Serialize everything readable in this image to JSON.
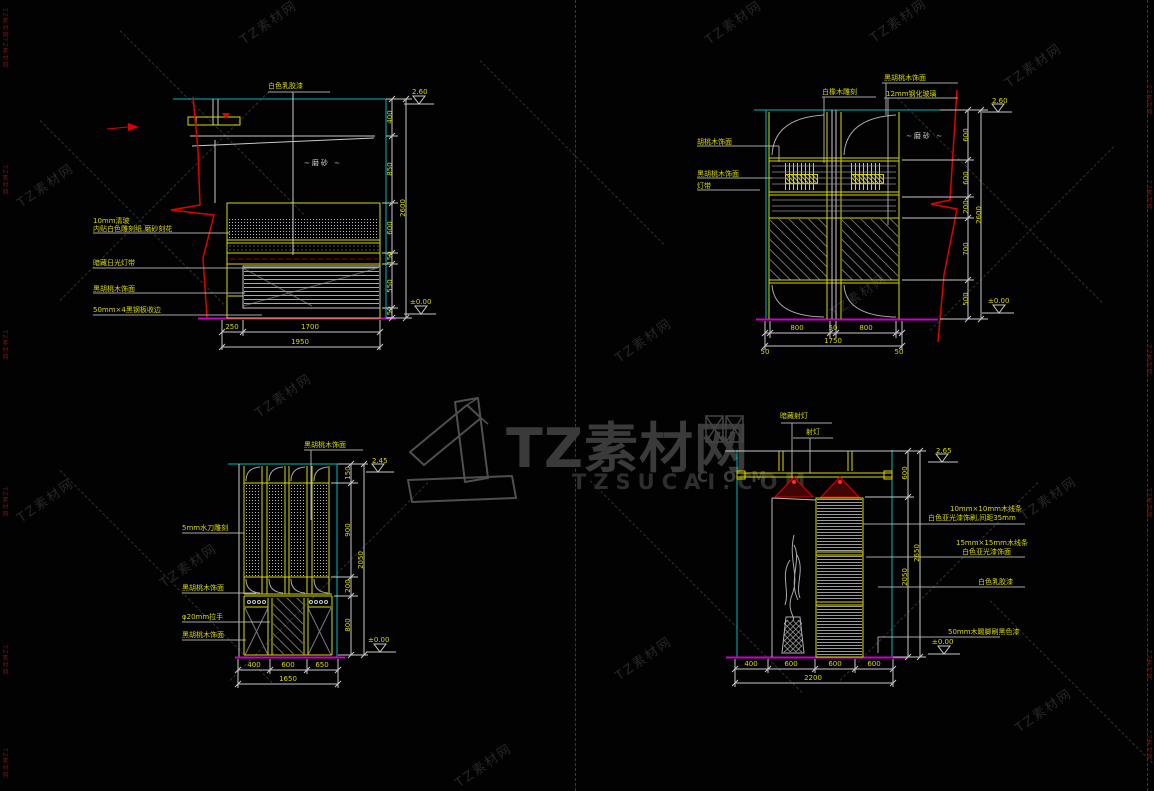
{
  "watermark": {
    "logo": "TZ素材网",
    "domain": "TZSUCAI.COM",
    "com": "C O M",
    "tile": "TZ素材网",
    "edge": "TZ素材网"
  },
  "d1": {
    "top_label": "白色乳胶漆",
    "frost_note": "∼磨砂 ∼",
    "left_labels": [
      "10mm清玻",
      "内贴白色雕刻纸,磨砂刻花",
      "暗藏日光灯带",
      "黑胡桃木饰面",
      "50mm×4黑钢板收边"
    ],
    "dims_right": [
      "400",
      "850",
      "600",
      "150",
      "550",
      "150"
    ],
    "overall_right": "2600",
    "level_top": "2.60",
    "level_bottom": "±0.00",
    "dims_bottom": [
      "250",
      "1700"
    ],
    "overall_bottom": "1950"
  },
  "d2": {
    "top_labels": [
      "黑胡桃木饰面",
      "白橡木雕刻",
      "12mm钢化玻璃"
    ],
    "left_labels": [
      "胡桃木饰面",
      "黑胡桃木饰面",
      "灯带"
    ],
    "frost_note": "∼磨砂 ∼",
    "dims_right": [
      "600",
      "600",
      "200",
      "700",
      "500"
    ],
    "overall_right": "2600",
    "level_top": "2.60",
    "level_bottom": "±0.00",
    "dims_bottom": [
      "800",
      "50",
      "800"
    ],
    "overall_bottom": "1750",
    "edge_dims": [
      "50",
      "50"
    ]
  },
  "d3": {
    "top_label": "黑胡桃木饰面",
    "left_labels": [
      "5mm水刀雕刻",
      "黑胡桃木饰面",
      "φ20mm拉手",
      "黑胡桃木饰面"
    ],
    "dims_right": [
      "150",
      "900",
      "200",
      "800"
    ],
    "overall_right": "2050",
    "level_top": "2.45",
    "level_bottom": "±0.00",
    "dims_bottom": [
      "400",
      "600",
      "650"
    ],
    "overall_bottom": "1650"
  },
  "d4": {
    "top_labels": [
      "暗藏射灯",
      "射灯"
    ],
    "right_labels": [
      [
        "10mm×10mm木线条",
        "白色亚光漆饰刷,间距35mm"
      ],
      [
        "15mm×15mm木线条",
        "白色亚光漆饰面"
      ],
      [
        "白色乳胶漆"
      ],
      [
        "50mm木踢脚刷黑色漆"
      ]
    ],
    "dims_right": [
      "600",
      "2050"
    ],
    "overall_right": "2650",
    "level_top": "2.65",
    "level_bottom": "±0.00",
    "dims_bottom": [
      "400",
      "600",
      "600",
      "600"
    ],
    "overall_bottom": "2200"
  }
}
